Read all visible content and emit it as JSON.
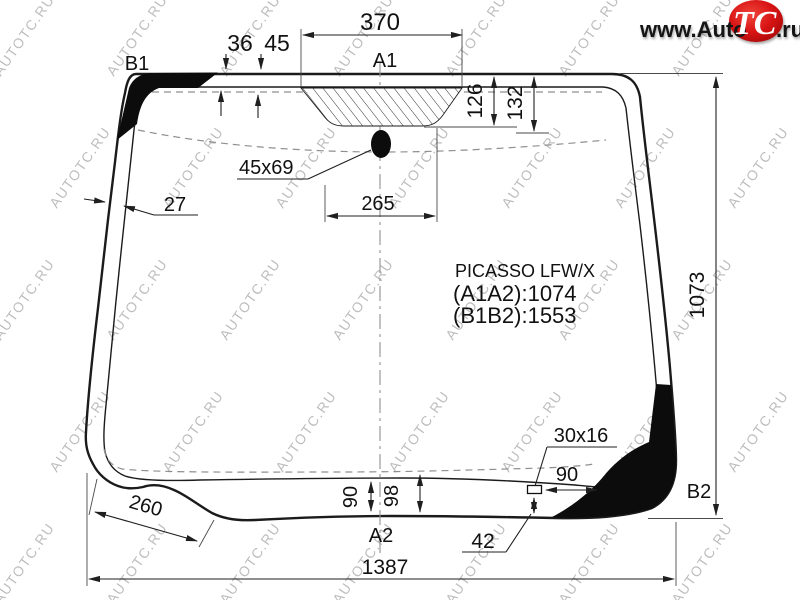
{
  "logo": {
    "www": "www.Auto",
    "tc": "TC",
    "ru": ".ru"
  },
  "watermark": {
    "text": "AUTOTC.RU"
  },
  "info": {
    "model": "PICASSO LFW/X",
    "a1a2": "(A1A2):1074",
    "b1b2": "(B1B2):1553"
  },
  "points": {
    "a1": "A1",
    "a2": "A2",
    "b1": "B1",
    "b2": "B2"
  },
  "dims": {
    "top_band_width": "370",
    "offset_36": "36",
    "offset_45": "45",
    "band_126": "126",
    "band_132": "132",
    "sensor_size": "45x69",
    "sensor_band_width": "265",
    "left_edge": "27",
    "glass_height": "1073",
    "bracket_size": "30x16",
    "bracket_offset": "90",
    "band_90": "90",
    "band_98": "98",
    "bracket_bottom": "42",
    "notch": "260",
    "glass_width": "1387"
  }
}
